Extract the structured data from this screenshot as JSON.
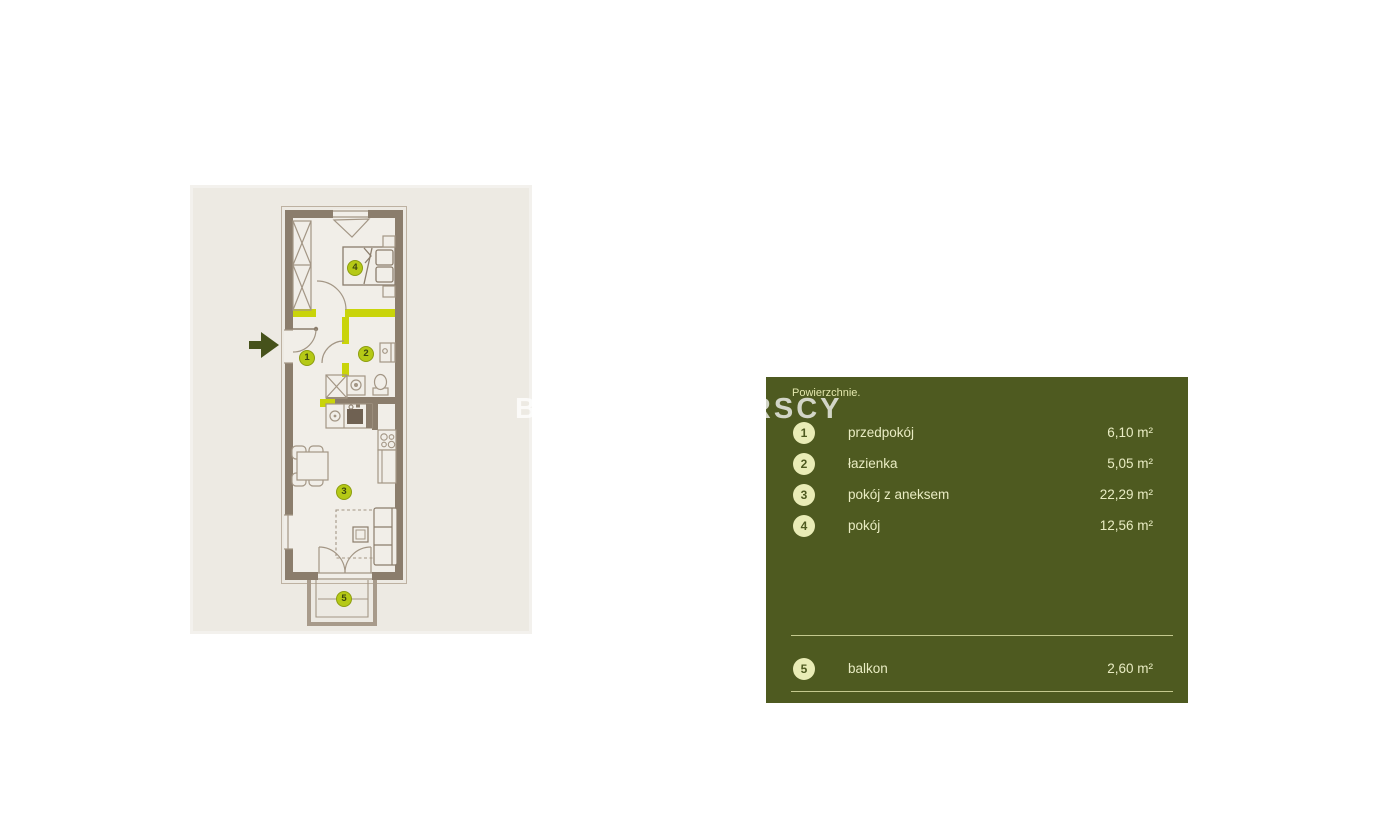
{
  "watermark": {
    "text": "BRACIA SADURSCY"
  },
  "plan": {
    "markers": [
      "1",
      "2",
      "3",
      "4",
      "5"
    ],
    "colors": {
      "card_background": "#edeae3",
      "wall": "#8b7d6c",
      "highlight_wall": "#c9d40a",
      "marker_fill": "#b5c916",
      "entrance_arrow": "#46521b"
    }
  },
  "legend": {
    "title": "Powierzchnie.",
    "panel_color": "#4e5a20",
    "text_color": "#e9ecc3",
    "badge_color": "#e9ecb6",
    "items": [
      {
        "num": "1",
        "label": "przedpokój",
        "area": "6,10 m²"
      },
      {
        "num": "2",
        "label": "łazienka",
        "area": "5,05 m²"
      },
      {
        "num": "3",
        "label": "pokój z aneksem",
        "area": "22,29 m²"
      },
      {
        "num": "4",
        "label": "pokój",
        "area": "12,56 m²"
      },
      {
        "num": "5",
        "label": "balkon",
        "area": "2,60 m²"
      }
    ]
  }
}
